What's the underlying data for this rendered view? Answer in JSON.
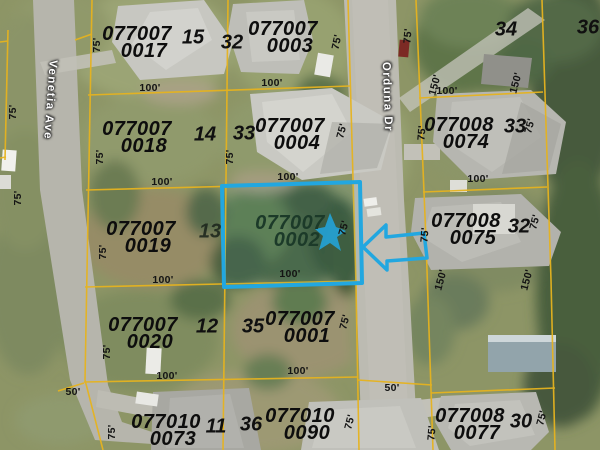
{
  "map": {
    "selected_parcel": {
      "parcel_id": "077007 0002"
    },
    "colors": {
      "boundary_line": "#e6b31f",
      "selection": "#22a7e0",
      "id_text": "#0d0d0d",
      "selected_id_text": "#1c3a29",
      "street_text": "#ffffff"
    },
    "streets": [
      {
        "name": "Venetia Ave",
        "x": 50,
        "y": 100,
        "rot": 94
      },
      {
        "name": "Orduna Dr",
        "x": 387,
        "y": 97,
        "rot": 88
      }
    ],
    "parcels": [
      {
        "id_line1": "077007",
        "id_line2": "0017",
        "x": 137,
        "y": 26,
        "highlighted": false
      },
      {
        "id_line1": "077007",
        "id_line2": "0003",
        "x": 283,
        "y": 21,
        "highlighted": false
      },
      {
        "id_line1": "077007",
        "id_line2": "0018",
        "x": 137,
        "y": 121,
        "highlighted": false
      },
      {
        "id_line1": "077007",
        "id_line2": "0004",
        "x": 290,
        "y": 118,
        "highlighted": false
      },
      {
        "id_line1": "077008",
        "id_line2": "0074",
        "x": 459,
        "y": 117,
        "highlighted": false
      },
      {
        "id_line1": "077007",
        "id_line2": "0019",
        "x": 141,
        "y": 221,
        "highlighted": false
      },
      {
        "id_line1": "077007",
        "id_line2": "0002",
        "x": 290,
        "y": 215,
        "highlighted": true
      },
      {
        "id_line1": "077008",
        "id_line2": "0075",
        "x": 466,
        "y": 213,
        "highlighted": false
      },
      {
        "id_line1": "077007",
        "id_line2": "0020",
        "x": 143,
        "y": 317,
        "highlighted": false
      },
      {
        "id_line1": "077007",
        "id_line2": "0001",
        "x": 300,
        "y": 311,
        "highlighted": false
      },
      {
        "id_line1": "077010",
        "id_line2": "0073",
        "x": 166,
        "y": 414,
        "highlighted": false
      },
      {
        "id_line1": "077010",
        "id_line2": "0090",
        "x": 300,
        "y": 408,
        "highlighted": false
      },
      {
        "id_line1": "077008",
        "id_line2": "0077",
        "x": 470,
        "y": 408,
        "highlighted": false
      }
    ],
    "lot_numbers": [
      {
        "value": "15",
        "x": 193,
        "y": 38
      },
      {
        "value": "32",
        "x": 232,
        "y": 43
      },
      {
        "value": "34",
        "x": 506,
        "y": 30
      },
      {
        "value": "36",
        "x": 588,
        "y": 28
      },
      {
        "value": "14",
        "x": 205,
        "y": 135
      },
      {
        "value": "33",
        "x": 244,
        "y": 134
      },
      {
        "value": "33",
        "x": 515,
        "y": 127
      },
      {
        "value": "13",
        "x": 210,
        "y": 232,
        "muted": true
      },
      {
        "value": "32",
        "x": 519,
        "y": 227
      },
      {
        "value": "12",
        "x": 207,
        "y": 327
      },
      {
        "value": "35",
        "x": 253,
        "y": 327
      },
      {
        "value": "11",
        "x": 216,
        "y": 427
      },
      {
        "value": "36",
        "x": 251,
        "y": 425
      },
      {
        "value": "30",
        "x": 521,
        "y": 422
      }
    ],
    "dimension_labels": [
      {
        "text": "75'",
        "x": 97,
        "y": 45,
        "rot": -90
      },
      {
        "text": "75'",
        "x": 13,
        "y": 112,
        "rot": -90
      },
      {
        "text": "75'",
        "x": 18,
        "y": 198,
        "rot": -90
      },
      {
        "text": "100'",
        "x": 150,
        "y": 88,
        "rot": 0
      },
      {
        "text": "100'",
        "x": 272,
        "y": 83,
        "rot": 0
      },
      {
        "text": "75'",
        "x": 337,
        "y": 42,
        "rot": -78
      },
      {
        "text": "100'",
        "x": 162,
        "y": 182,
        "rot": 0
      },
      {
        "text": "75'",
        "x": 100,
        "y": 157,
        "rot": -90
      },
      {
        "text": "75'",
        "x": 230,
        "y": 157,
        "rot": -90
      },
      {
        "text": "75'",
        "x": 342,
        "y": 131,
        "rot": -75
      },
      {
        "text": "100'",
        "x": 288,
        "y": 177,
        "rot": 0
      },
      {
        "text": "75'",
        "x": 103,
        "y": 252,
        "rot": -90
      },
      {
        "text": "100'",
        "x": 163,
        "y": 280,
        "rot": 0
      },
      {
        "text": "75'",
        "x": 344,
        "y": 228,
        "rot": -75
      },
      {
        "text": "100'",
        "x": 290,
        "y": 274,
        "rot": 0
      },
      {
        "text": "75'",
        "x": 107,
        "y": 352,
        "rot": -90
      },
      {
        "text": "100'",
        "x": 167,
        "y": 376,
        "rot": 0
      },
      {
        "text": "50'",
        "x": 73,
        "y": 392,
        "rot": 0
      },
      {
        "text": "75'",
        "x": 345,
        "y": 322,
        "rot": -75
      },
      {
        "text": "100'",
        "x": 298,
        "y": 371,
        "rot": 0
      },
      {
        "text": "50'",
        "x": 392,
        "y": 388,
        "rot": 0
      },
      {
        "text": "75'",
        "x": 112,
        "y": 432,
        "rot": -90
      },
      {
        "text": "75'",
        "x": 350,
        "y": 422,
        "rot": -75
      },
      {
        "text": "75'",
        "x": 432,
        "y": 433,
        "rot": -85
      },
      {
        "text": "75'",
        "x": 542,
        "y": 418,
        "rot": -75
      },
      {
        "text": "75'",
        "x": 422,
        "y": 133,
        "rot": -85
      },
      {
        "text": "75'",
        "x": 530,
        "y": 126,
        "rot": -75
      },
      {
        "text": "100'",
        "x": 478,
        "y": 179,
        "rot": 0
      },
      {
        "text": "75'",
        "x": 425,
        "y": 235,
        "rot": -85
      },
      {
        "text": "75'",
        "x": 535,
        "y": 222,
        "rot": -75
      },
      {
        "text": "150'",
        "x": 441,
        "y": 280,
        "rot": -75
      },
      {
        "text": "150'",
        "x": 527,
        "y": 280,
        "rot": -75
      },
      {
        "text": "150'",
        "x": 435,
        "y": 85,
        "rot": -75
      },
      {
        "text": "150'",
        "x": 516,
        "y": 83,
        "rot": -75
      },
      {
        "text": "100'",
        "x": 447,
        "y": 91,
        "rot": 0
      },
      {
        "text": "75'",
        "x": 408,
        "y": 36,
        "rot": -85
      }
    ]
  }
}
